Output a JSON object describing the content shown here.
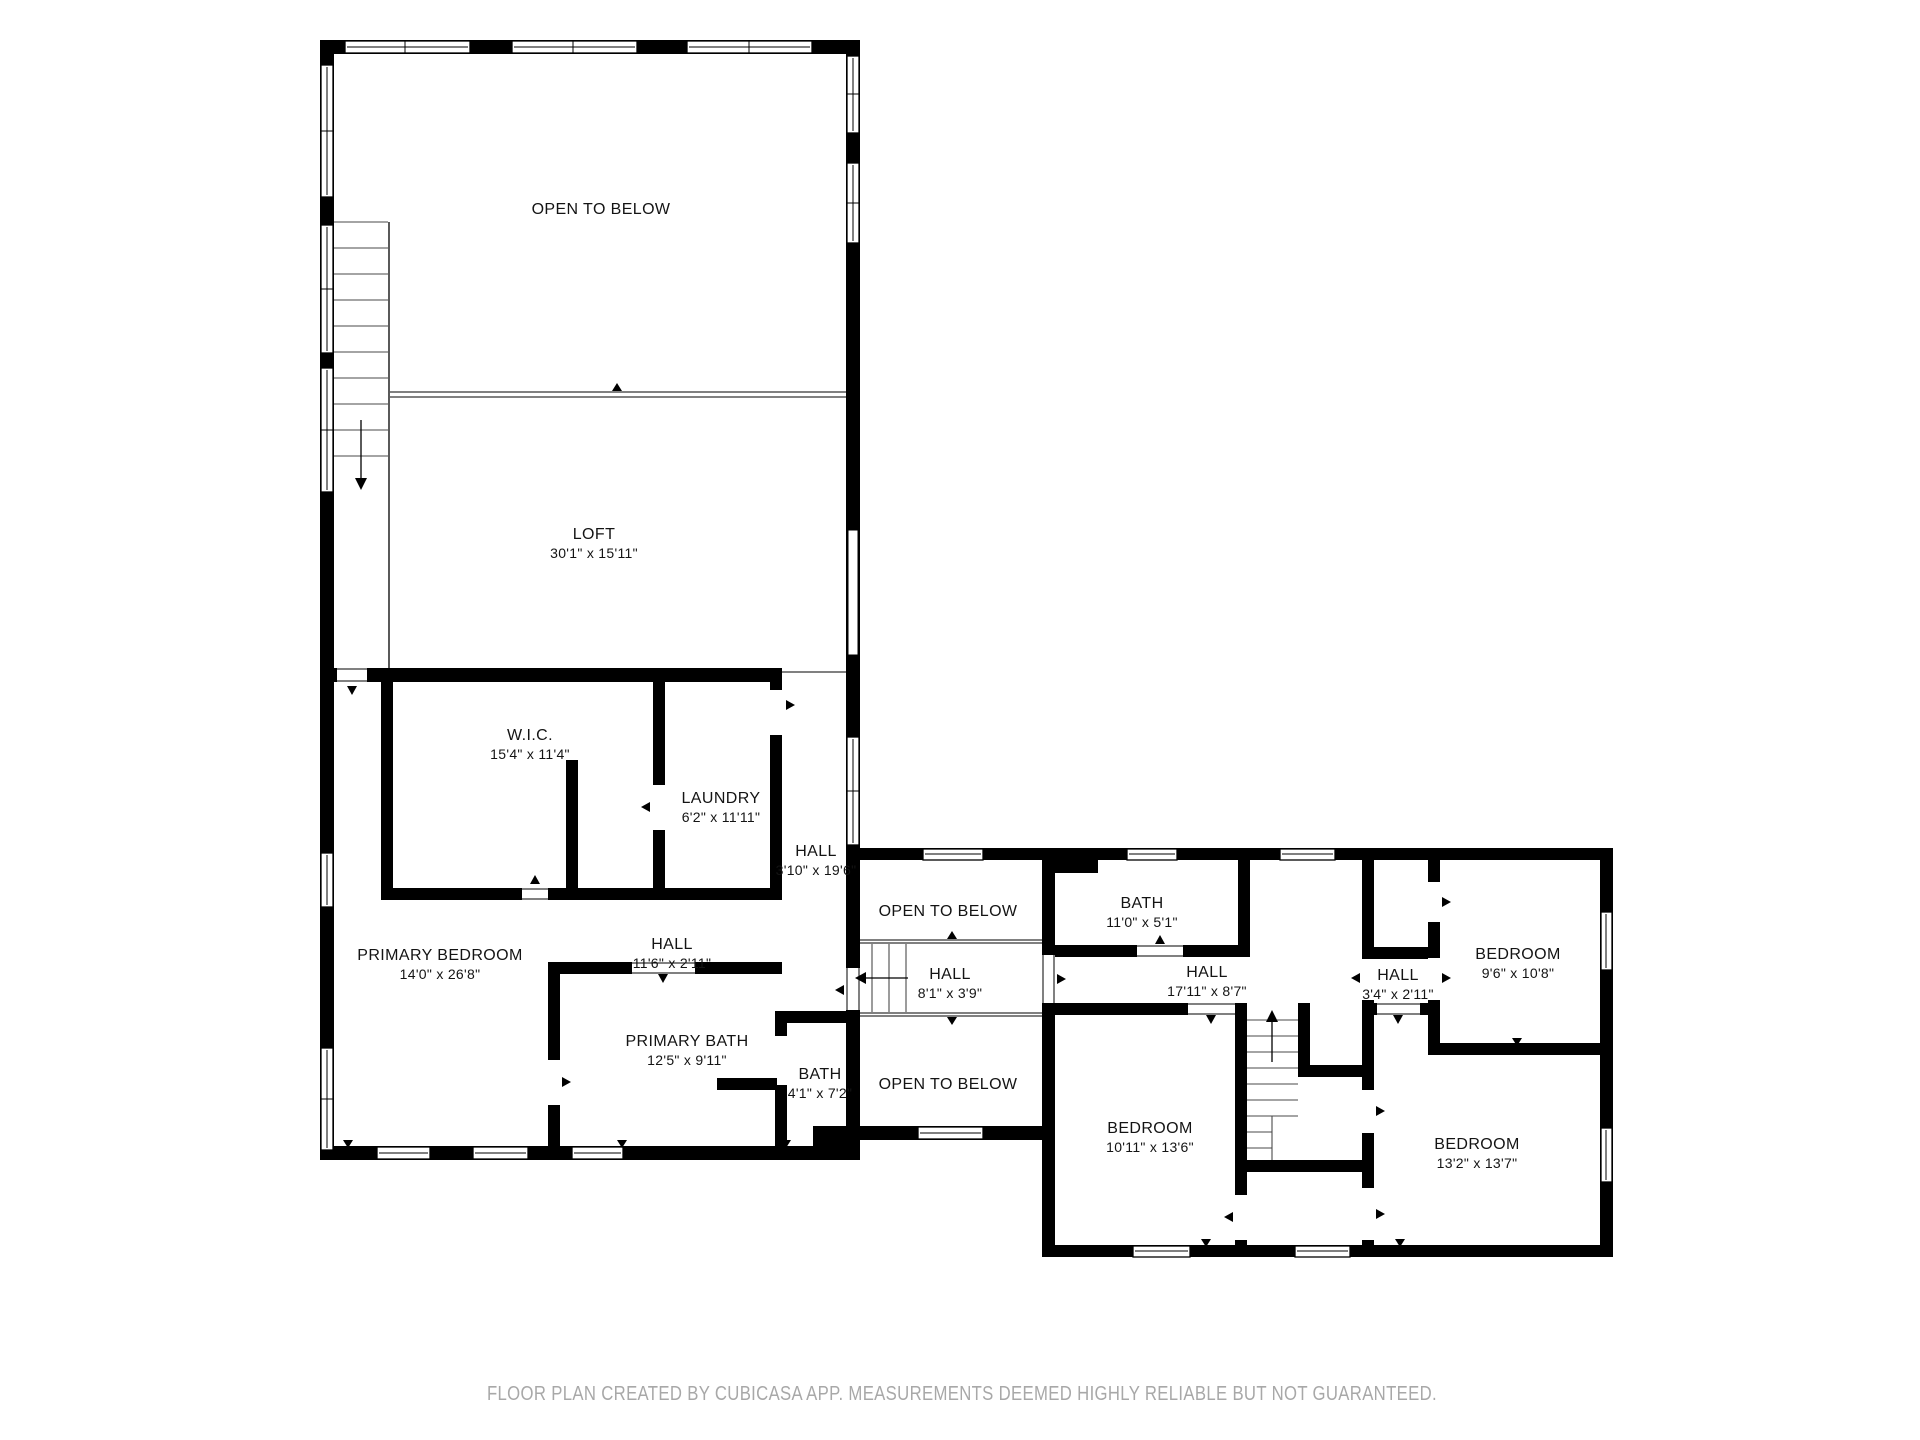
{
  "rooms": {
    "open_below_top": {
      "name": "OPEN TO BELOW"
    },
    "loft": {
      "name": "LOFT",
      "dims": "30'1\" x 15'11\""
    },
    "wic": {
      "name": "W.I.C.",
      "dims": "15'4\" x 11'4\""
    },
    "laundry": {
      "name": "LAUNDRY",
      "dims": "6'2\" x 11'11\""
    },
    "hall_upper": {
      "name": "HALL",
      "dims": "3'10\" x 19'6\""
    },
    "primary_bedroom": {
      "name": "PRIMARY BEDROOM",
      "dims": "14'0\" x 26'8\""
    },
    "hall_primary": {
      "name": "HALL",
      "dims": "11'6\" x 2'11\""
    },
    "primary_bath": {
      "name": "PRIMARY BATH",
      "dims": "12'5\" x 9'11\""
    },
    "bath_small": {
      "name": "BATH",
      "dims": "4'1\" x 7'2\""
    },
    "open_below_mid_top": {
      "name": "OPEN TO BELOW"
    },
    "hall_stairs": {
      "name": "HALL",
      "dims": "8'1\" x 3'9\""
    },
    "open_below_mid_bottom": {
      "name": "OPEN TO BELOW"
    },
    "bath_main": {
      "name": "BATH",
      "dims": "11'0\" x 5'1\""
    },
    "hall_main": {
      "name": "HALL",
      "dims": "17'11\" x 8'7\""
    },
    "hall_small": {
      "name": "HALL",
      "dims": "3'4\" x 2'11\""
    },
    "bedroom_ne": {
      "name": "BEDROOM",
      "dims": "9'6\" x 10'8\""
    },
    "bedroom_sw": {
      "name": "BEDROOM",
      "dims": "10'11\" x 13'6\""
    },
    "bedroom_se": {
      "name": "BEDROOM",
      "dims": "13'2\" x 13'7\""
    }
  },
  "footer": {
    "text": "FLOOR PLAN CREATED BY CUBICASA APP. MEASUREMENTS DEEMED HIGHLY RELIABLE BUT NOT GUARANTEED."
  },
  "colors": {
    "wall": "#000000",
    "background": "#ffffff",
    "footer_text": "#a8a8a8"
  }
}
